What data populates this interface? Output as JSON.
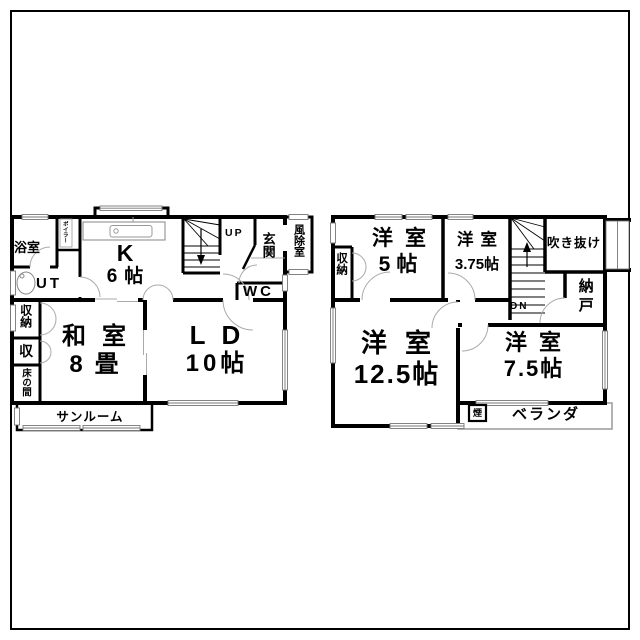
{
  "page": {
    "background": "#ffffff",
    "border_color": "#000000",
    "wall_color": "#000000",
    "thin_line_color": "#999999"
  },
  "floor1": {
    "bath": "浴室",
    "boiler": "ボイラー",
    "ut": "UT",
    "kitchen": "K",
    "kitchen_size": "6帖",
    "up": "UP",
    "entrance": "玄関",
    "windbreak": "風除室",
    "wc": "WC",
    "closet1": "収納",
    "closet2": "収",
    "tokonoma": "床の間",
    "washitsu": "和室",
    "washitsu_size": "8畳",
    "ld": "LD",
    "ld_size": "10帖",
    "sunroom": "サンルーム"
  },
  "floor2": {
    "closet": "収納",
    "room_a": "洋室",
    "room_a_size": "5帖",
    "room_b": "洋室",
    "room_b_size": "3.75帖",
    "void": "吹き抜け",
    "dn": "DN",
    "storeroom": "納戸",
    "room_c": "洋室",
    "room_c_size": "12.5帖",
    "room_d": "洋室",
    "room_d_size": "7.5帖",
    "veranda": "ベランダ",
    "chimney": "煙"
  }
}
